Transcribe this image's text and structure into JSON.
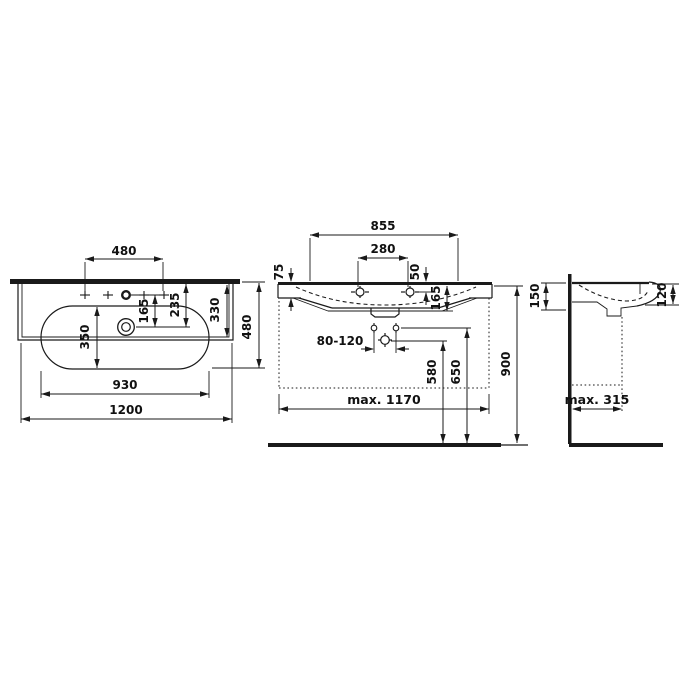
{
  "drawing": {
    "type": "washbasin technical dimension drawing",
    "colors": {
      "line": "#1a1a1a",
      "background": "#ffffff"
    }
  },
  "dimensions": {
    "top_view": {
      "tap_hole_spacing": "480",
      "tap_to_drain": "165",
      "rear_to_drain": "235",
      "bowl_width": "350",
      "deck_depth": "330",
      "overall_depth": "480",
      "bowl_length": "930",
      "overall_width": "1200"
    },
    "front_view": {
      "deck_width": "855",
      "tap_hole_pair_spacing": "280",
      "rim_thickness": "75",
      "rim_to_tap_hole": "50",
      "basin_depth": "165",
      "fixing_hole_range": "80-120",
      "drain_height": "580",
      "fixing_height": "650",
      "rim_height": "900",
      "max_width": "max. 1170"
    },
    "side_view": {
      "rear_height": "150",
      "front_height": "120",
      "max_depth": "max. 315"
    }
  }
}
